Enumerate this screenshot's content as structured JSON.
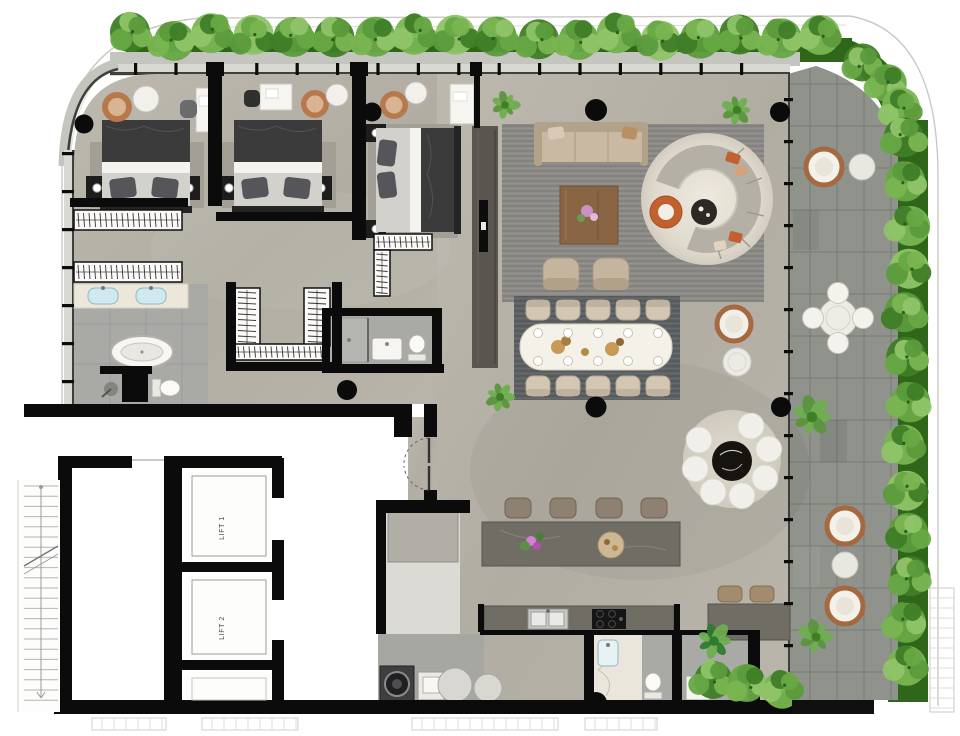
{
  "title": "Penthouse apartment floor plan with wraparound terrace",
  "labels": {
    "lift1": "LIFT 1",
    "lift2": "LIFT 2"
  },
  "counts": {
    "bedrooms": 3,
    "bathrooms": 4,
    "lifts": 2,
    "dining_chairs": 10,
    "bar_stools": 4,
    "terrace_lounge_chairs": 3
  },
  "palette": {
    "bg": "#ffffff",
    "wall": "#0b0b0b",
    "floor_a": "#bcb8ae",
    "floor_b": "#aeaaa0",
    "paver": "#90928c",
    "ledge": "#c4c5be",
    "hedge": "#67a845",
    "hedge_dark": "#3f7d27",
    "hedge_light": "#8fc468",
    "grass": "#2f6619",
    "rug_living": "#8d8c88",
    "rug_dining": "#5f6265",
    "rug_round": "#e3dfd4",
    "rug_bed": "#a39f96",
    "tile_bath": "#a9aaa6",
    "marble": "#ece7da",
    "island": "#6f6d64",
    "wood": "#8a6544",
    "sofa": "#c9b9a3",
    "chair_tan": "#b7794c",
    "white_furn": "#f1efe9",
    "black_furn": "#1d1d1b",
    "sink_blue": "#cfe9ef",
    "accent_orange": "#c2602e"
  }
}
